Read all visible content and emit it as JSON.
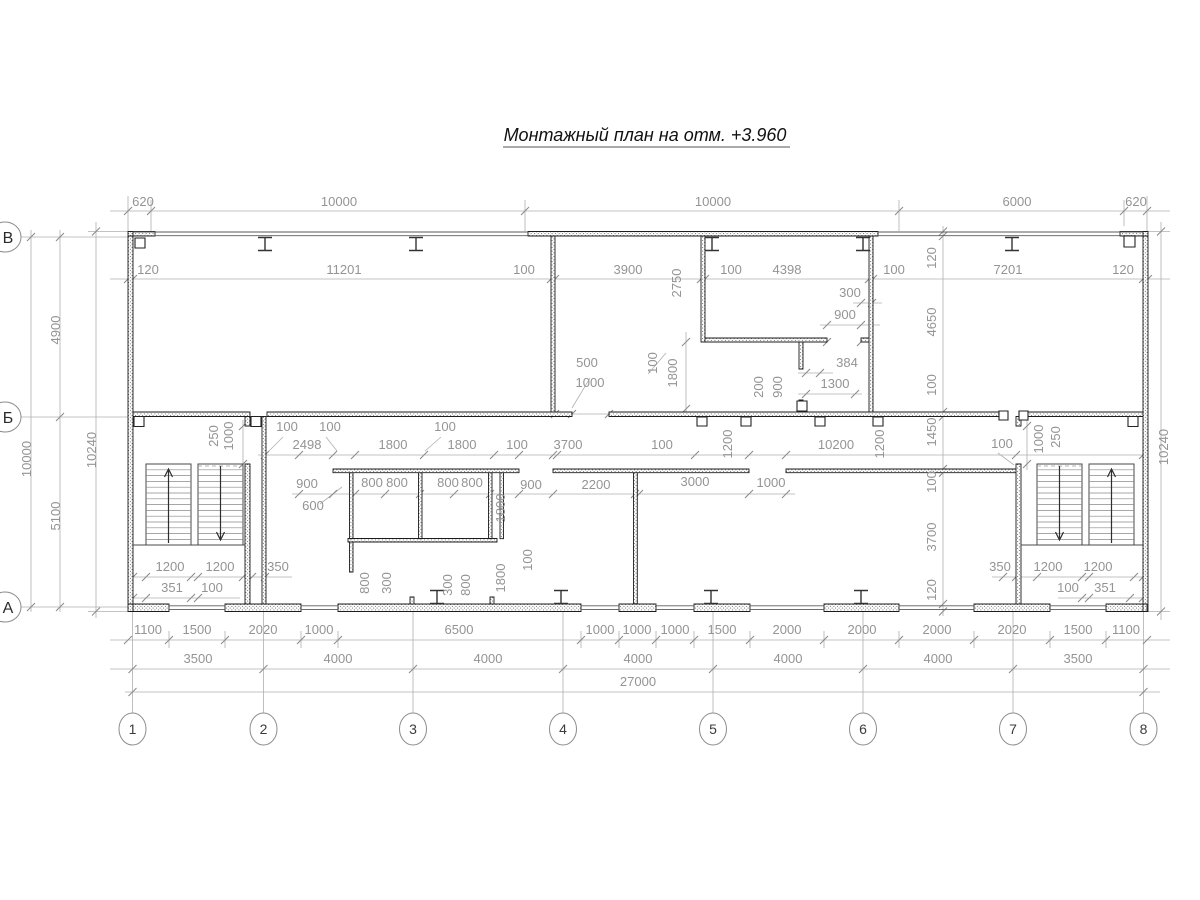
{
  "title": "Монтажный план на отм. +3.960",
  "axes": {
    "columns": [
      "1",
      "2",
      "3",
      "4",
      "5",
      "6",
      "7",
      "8"
    ],
    "rows": [
      "В",
      "Б",
      "А"
    ]
  },
  "dims": {
    "top_outer": [
      "620",
      "10000",
      "10000",
      "6000",
      "620"
    ],
    "top_inner": [
      "120",
      "11201",
      "100",
      "3900",
      "100",
      "4398",
      "100",
      "7201",
      "120"
    ],
    "left_side": [
      "4900",
      "10000",
      "5100",
      "10240"
    ],
    "right_side": [
      "10240"
    ],
    "right_chain": [
      "120",
      "4650",
      "100",
      "1450",
      "100",
      "3700",
      "120"
    ],
    "upper_room": [
      "2750",
      "500",
      "1000",
      "100",
      "1800",
      "200",
      "900",
      "300",
      "900",
      "384",
      "1300"
    ],
    "middle_band": [
      "250",
      "1000",
      "100",
      "100",
      "2498",
      "1800",
      "100",
      "1800",
      "100",
      "3700",
      "100",
      "1200",
      "10200",
      "1200",
      "100",
      "1000",
      "250"
    ],
    "lower_band": [
      "900",
      "600",
      "800",
      "800",
      "800",
      "800",
      "1800",
      "900",
      "2200",
      "1800",
      "100",
      "3000",
      "1000"
    ],
    "wc_bottom": [
      "800",
      "300",
      "300",
      "800"
    ],
    "stair_left": [
      "1200",
      "1200",
      "350",
      "351",
      "100"
    ],
    "stair_right": [
      "350",
      "1200",
      "1200",
      "100",
      "351"
    ],
    "bottom_openings": [
      "1100",
      "1500",
      "2020",
      "1000",
      "6500",
      "1000",
      "1000",
      "1000",
      "1500",
      "2000",
      "2000",
      "2000",
      "2020",
      "1500",
      "1100"
    ],
    "bottom_axes": [
      "3500",
      "4000",
      "4000",
      "4000",
      "4000",
      "4000",
      "3500"
    ],
    "total_width": "27000"
  }
}
